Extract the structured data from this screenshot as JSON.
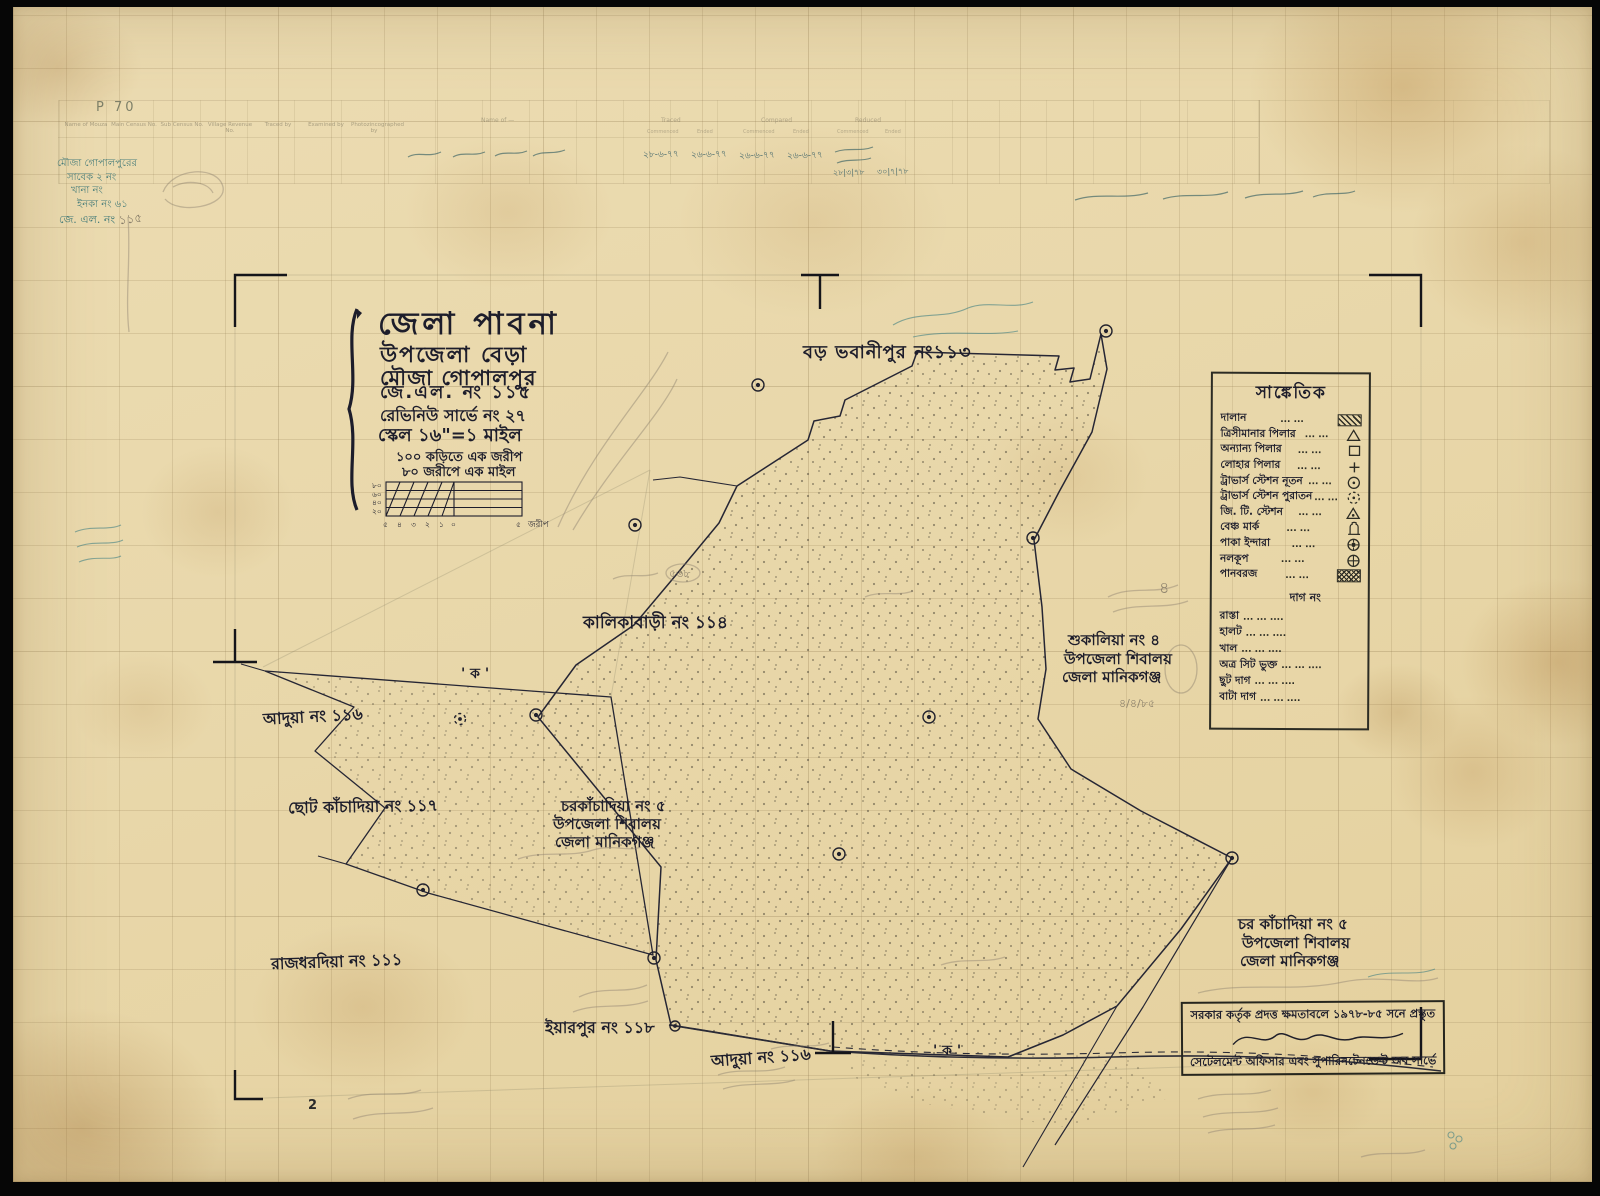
{
  "page": {
    "sheet_label": "P 70"
  },
  "colors": {
    "paper": "#e9d8ab",
    "ink": "#23232e",
    "teal_ink": "#2f6f72",
    "pencil": "#8b8172",
    "stain": "#a87430",
    "border": "#060606"
  },
  "survey_table": {
    "headers": [
      "Name of Mouza",
      "Main Census No.",
      "Sub Census No.",
      "Village Revenue No.",
      "Traced by",
      "Examined by",
      "Photozincographed by"
    ],
    "group_label": "Name of —",
    "group_headers": [
      "Traced",
      "Compared",
      "Reduced"
    ],
    "sub_headers": [
      "Commenced",
      "Ended"
    ],
    "dates": [
      "২৮-৬-৭৭",
      "২৬-৬-৭৭",
      "২৬-৬-৭৭",
      "২৬-৬-৭৭"
    ],
    "dates2": [
      "২৮|৩|৭৮",
      "৩০|৭|৭৮"
    ]
  },
  "margin": {
    "notes": [
      "মৌজা গোপালপুরের",
      "সাবেক ২ নং",
      "খানা নং",
      "ইনকা নং ৬১"
    ],
    "jl_prefix": "জে. এল. নং",
    "pencil_no": "১১৫"
  },
  "title_block": {
    "district": "জেলা পাবনা",
    "upazila": "উপজেলা বেড়া",
    "mouza": "মৌজা গোপালপুর",
    "jl_no": "জে.এল. নং ১১৫",
    "revenue_survey": "রেভিনিউ সার্ভে নং ২৭",
    "scale": "স্কেল ১৬\"=১ মাইল",
    "note1": "১০০ কড়িতে এক জরীপ",
    "note2": "৮০ জরীপে এক মাইল"
  },
  "scale_bar": {
    "y": [
      "৮০",
      "৬০",
      "৪০",
      "২০"
    ],
    "x": [
      "৫",
      "৪",
      "৩",
      "২",
      "১",
      "০"
    ],
    "right": "৫",
    "unit": "জরীপ"
  },
  "legend": {
    "title": "সাঙ্কেতিক",
    "leader": "...   ...",
    "items": [
      {
        "label": "দালান",
        "icon": "hatched-rect"
      },
      {
        "label": "ত্রিসীমানার পিলার",
        "icon": "triangle"
      },
      {
        "label": "অন্যান্য পিলার",
        "icon": "square"
      },
      {
        "label": "লোহার পিলার",
        "icon": "plus"
      },
      {
        "label": "ট্রাভার্স স্টেশন নূতন",
        "icon": "circle-dot"
      },
      {
        "label": "ট্রাভার্স স্টেশন পুরাতন",
        "icon": "dashed-circle-dot"
      },
      {
        "label": "জি. টি. স্টেশন",
        "icon": "triangle-dot"
      },
      {
        "label": "বেঞ্চ মার্ক",
        "icon": "bench-mark"
      },
      {
        "label": "পাকা ইন্দারা",
        "icon": "masonry-well"
      },
      {
        "label": "নলকূপ",
        "icon": "circle-cross"
      },
      {
        "label": "পানবরজ",
        "icon": "crosshatched-rect"
      }
    ],
    "dag_header": "দাগ নং",
    "dag_leader": "... ... ....",
    "dag_items": [
      {
        "label": "রাস্তা"
      },
      {
        "label": "হালট"
      },
      {
        "label": "খাল"
      },
      {
        "label": "অত্র সিট ভুক্ত"
      },
      {
        "label": "ছুট দাগ"
      },
      {
        "label": "বাটা দাগ"
      }
    ]
  },
  "map_labels": [
    {
      "line1": "বড় ভবানীপুর নং১১৩"
    },
    {
      "line1": "কালিকাবাড়ী নং ১১৪"
    },
    {
      "line1": "আদুয়া নং ১১৬"
    },
    {
      "line1": "ছোট কাঁচাদিয়া নং ১১৭"
    },
    {
      "line1": "চরকাঁচাদিয়া নং ৫",
      "line2": "উপজেলা শিবালয়",
      "line3": "জেলা মানিকগঞ্জ"
    },
    {
      "line1": "শুকালিয়া নং ৪",
      "line2": "উপজেলা শিবালয়",
      "line3": "জেলা মানিকগঞ্জ"
    },
    {
      "line1": "রাজধরদিয়া নং ১১১"
    },
    {
      "line1": "ইয়ারপুর নং ১১৮"
    },
    {
      "line1": "আদুয়া নং ১১৬"
    },
    {
      "line1": "চর কাঁচাদিয়া নং ৫",
      "line2": "উপজেলা শিবালয়",
      "line3": "জেলা মানিকগঞ্জ"
    },
    {
      "line1": "' ক '"
    },
    {
      "line1": "' ক '"
    }
  ],
  "stamp": {
    "line1": "সরকার কর্তৃক প্রদত্ত ক্ষমতাবলে ১৯৭৮-৮৫ সনে প্রস্তুত",
    "line2": "সেটেলমেন্ট অফিসার এবং সুপারিনটেনডেন্ট অব সার্ভে"
  },
  "annotations": {
    "plot_568": "৫৬৮",
    "dag_4": "৪",
    "date_note": "৪/৪/৮৫",
    "page_no": "2"
  }
}
